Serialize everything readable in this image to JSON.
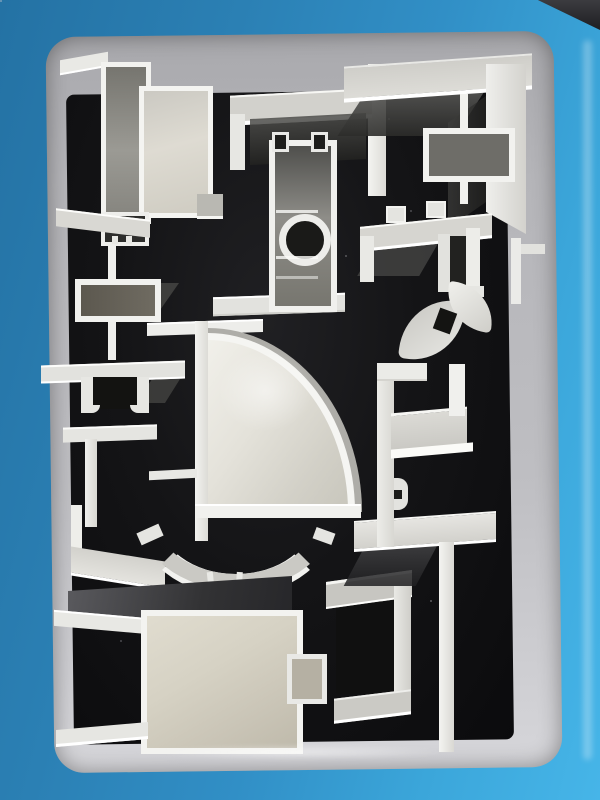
{
  "scene": {
    "description": "Photograph of aluminum extrusion profile cross-section samples mounted on a black foam display board inside a blue metal display frame, viewed at a slight angle",
    "frame": "blue painted display frame",
    "tray": "light gray inner tray border",
    "board": "black foam backing board",
    "piece_count": 18
  },
  "palette": {
    "frame_blue_dark": "#2472a4",
    "frame_blue": "#318fc6",
    "frame_blue_light": "#46b5e8",
    "tray_gray": "#bebec2",
    "tray_gray_light": "#d6d6da",
    "board_black": "#141416",
    "aluminum_bright": "#f2f2ef",
    "aluminum_face": "#d6d5d0",
    "aluminum_mid": "#bdbcb7",
    "aluminum_shadow": "#4a4a48",
    "interior_cream": "#d6d2c4"
  },
  "pieces": [
    {
      "id": "p1",
      "name": "window-frame-profile",
      "description": "tall twin rectangular tube frame profile with angled flanges, top-left"
    },
    {
      "id": "p2",
      "name": "u-channel-profile",
      "description": "wide U-channel opening downward, top-center"
    },
    {
      "id": "p3",
      "name": "mullion-profile-circular-core",
      "description": "vertical mullion tube with round screw boss and base plate, center-top"
    },
    {
      "id": "p4",
      "name": "corner-angle-profile-large",
      "description": "large L corner angle, top-right"
    },
    {
      "id": "p5",
      "name": "i-beam-box-profile",
      "description": "web with rectangular box core nested inside the corner angle"
    },
    {
      "id": "p6",
      "name": "hat-channel-profile-right",
      "description": "top-hat profile with T-slot tabs, right side"
    },
    {
      "id": "p7",
      "name": "ogee-curved-profile",
      "description": "small S-curved decorative profile, right-middle"
    },
    {
      "id": "p8",
      "name": "i-beam-box-profile-left",
      "description": "web with rectangular box core, left-middle"
    },
    {
      "id": "p9",
      "name": "hat-channel-profile-left",
      "description": "flanged hat channel with hooked legs, left"
    },
    {
      "id": "p10",
      "name": "l-angle-profile-left",
      "description": "L angle profile, left-middle"
    },
    {
      "id": "p11",
      "name": "quarter-round-corner-profile",
      "description": "large quarter-circle rounded corner profile, center"
    },
    {
      "id": "p12",
      "name": "l-angle-profile-bottom-left",
      "description": "L angle profile, lower-left"
    },
    {
      "id": "p13",
      "name": "arc-profile",
      "description": "curved arc profile with two hooked feet, lower-center"
    },
    {
      "id": "p14",
      "name": "box-profile-with-flanges",
      "description": "large rectangular tube with side flanges and right tab, bottom-left"
    },
    {
      "id": "p15",
      "name": "c-channel-profile",
      "description": "C channel opening left, bottom-center"
    },
    {
      "id": "p16",
      "name": "t-profile",
      "description": "large T profile, bottom-right"
    },
    {
      "id": "p17",
      "name": "z-step-profile",
      "description": "stepped Z profile with shelf, right-middle"
    },
    {
      "id": "p18",
      "name": "edge-angle-profile-right",
      "description": "small angle piece near right tray edge"
    }
  ]
}
